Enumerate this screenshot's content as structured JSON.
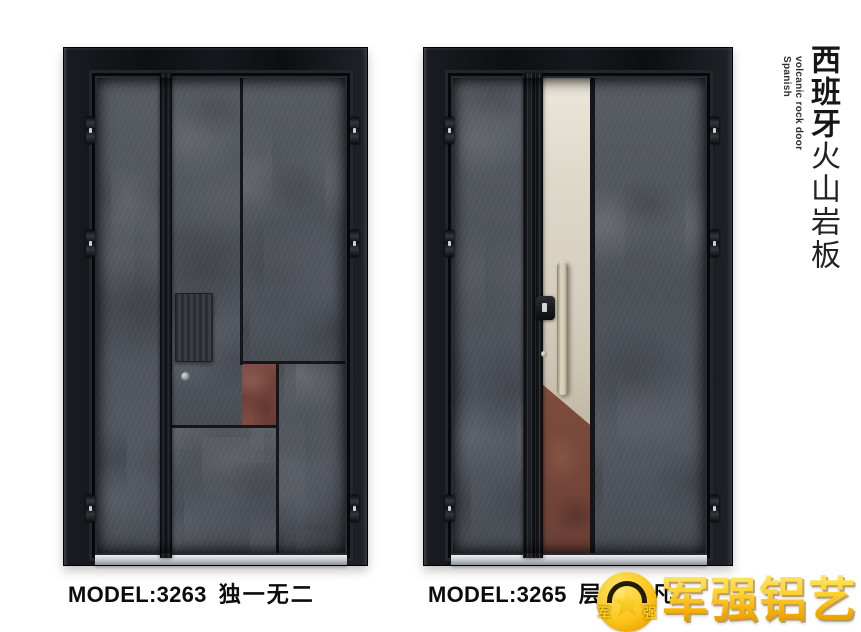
{
  "page": {
    "background": "#ffffff"
  },
  "catalog": {
    "products": [
      {
        "model_label": "MODEL:3263",
        "name": "独一无二"
      },
      {
        "model_label": "MODEL:3265",
        "name": "层山不凡"
      }
    ],
    "side_title": {
      "zh_bold": "西班牙",
      "zh_light": "火山岩板",
      "en_line1": "Spanish",
      "en_line2": "volcanic rock door"
    },
    "logo": {
      "text": "军强铝艺",
      "emblem_char_left": "军",
      "emblem_char_right": "强"
    },
    "colors": {
      "rock_gray": "#4f5359",
      "rust_copper": "#7c4a3a",
      "champagne": "#d6cfbf",
      "frame_black": "#101215",
      "logo_gold": "#f6b80c"
    }
  }
}
